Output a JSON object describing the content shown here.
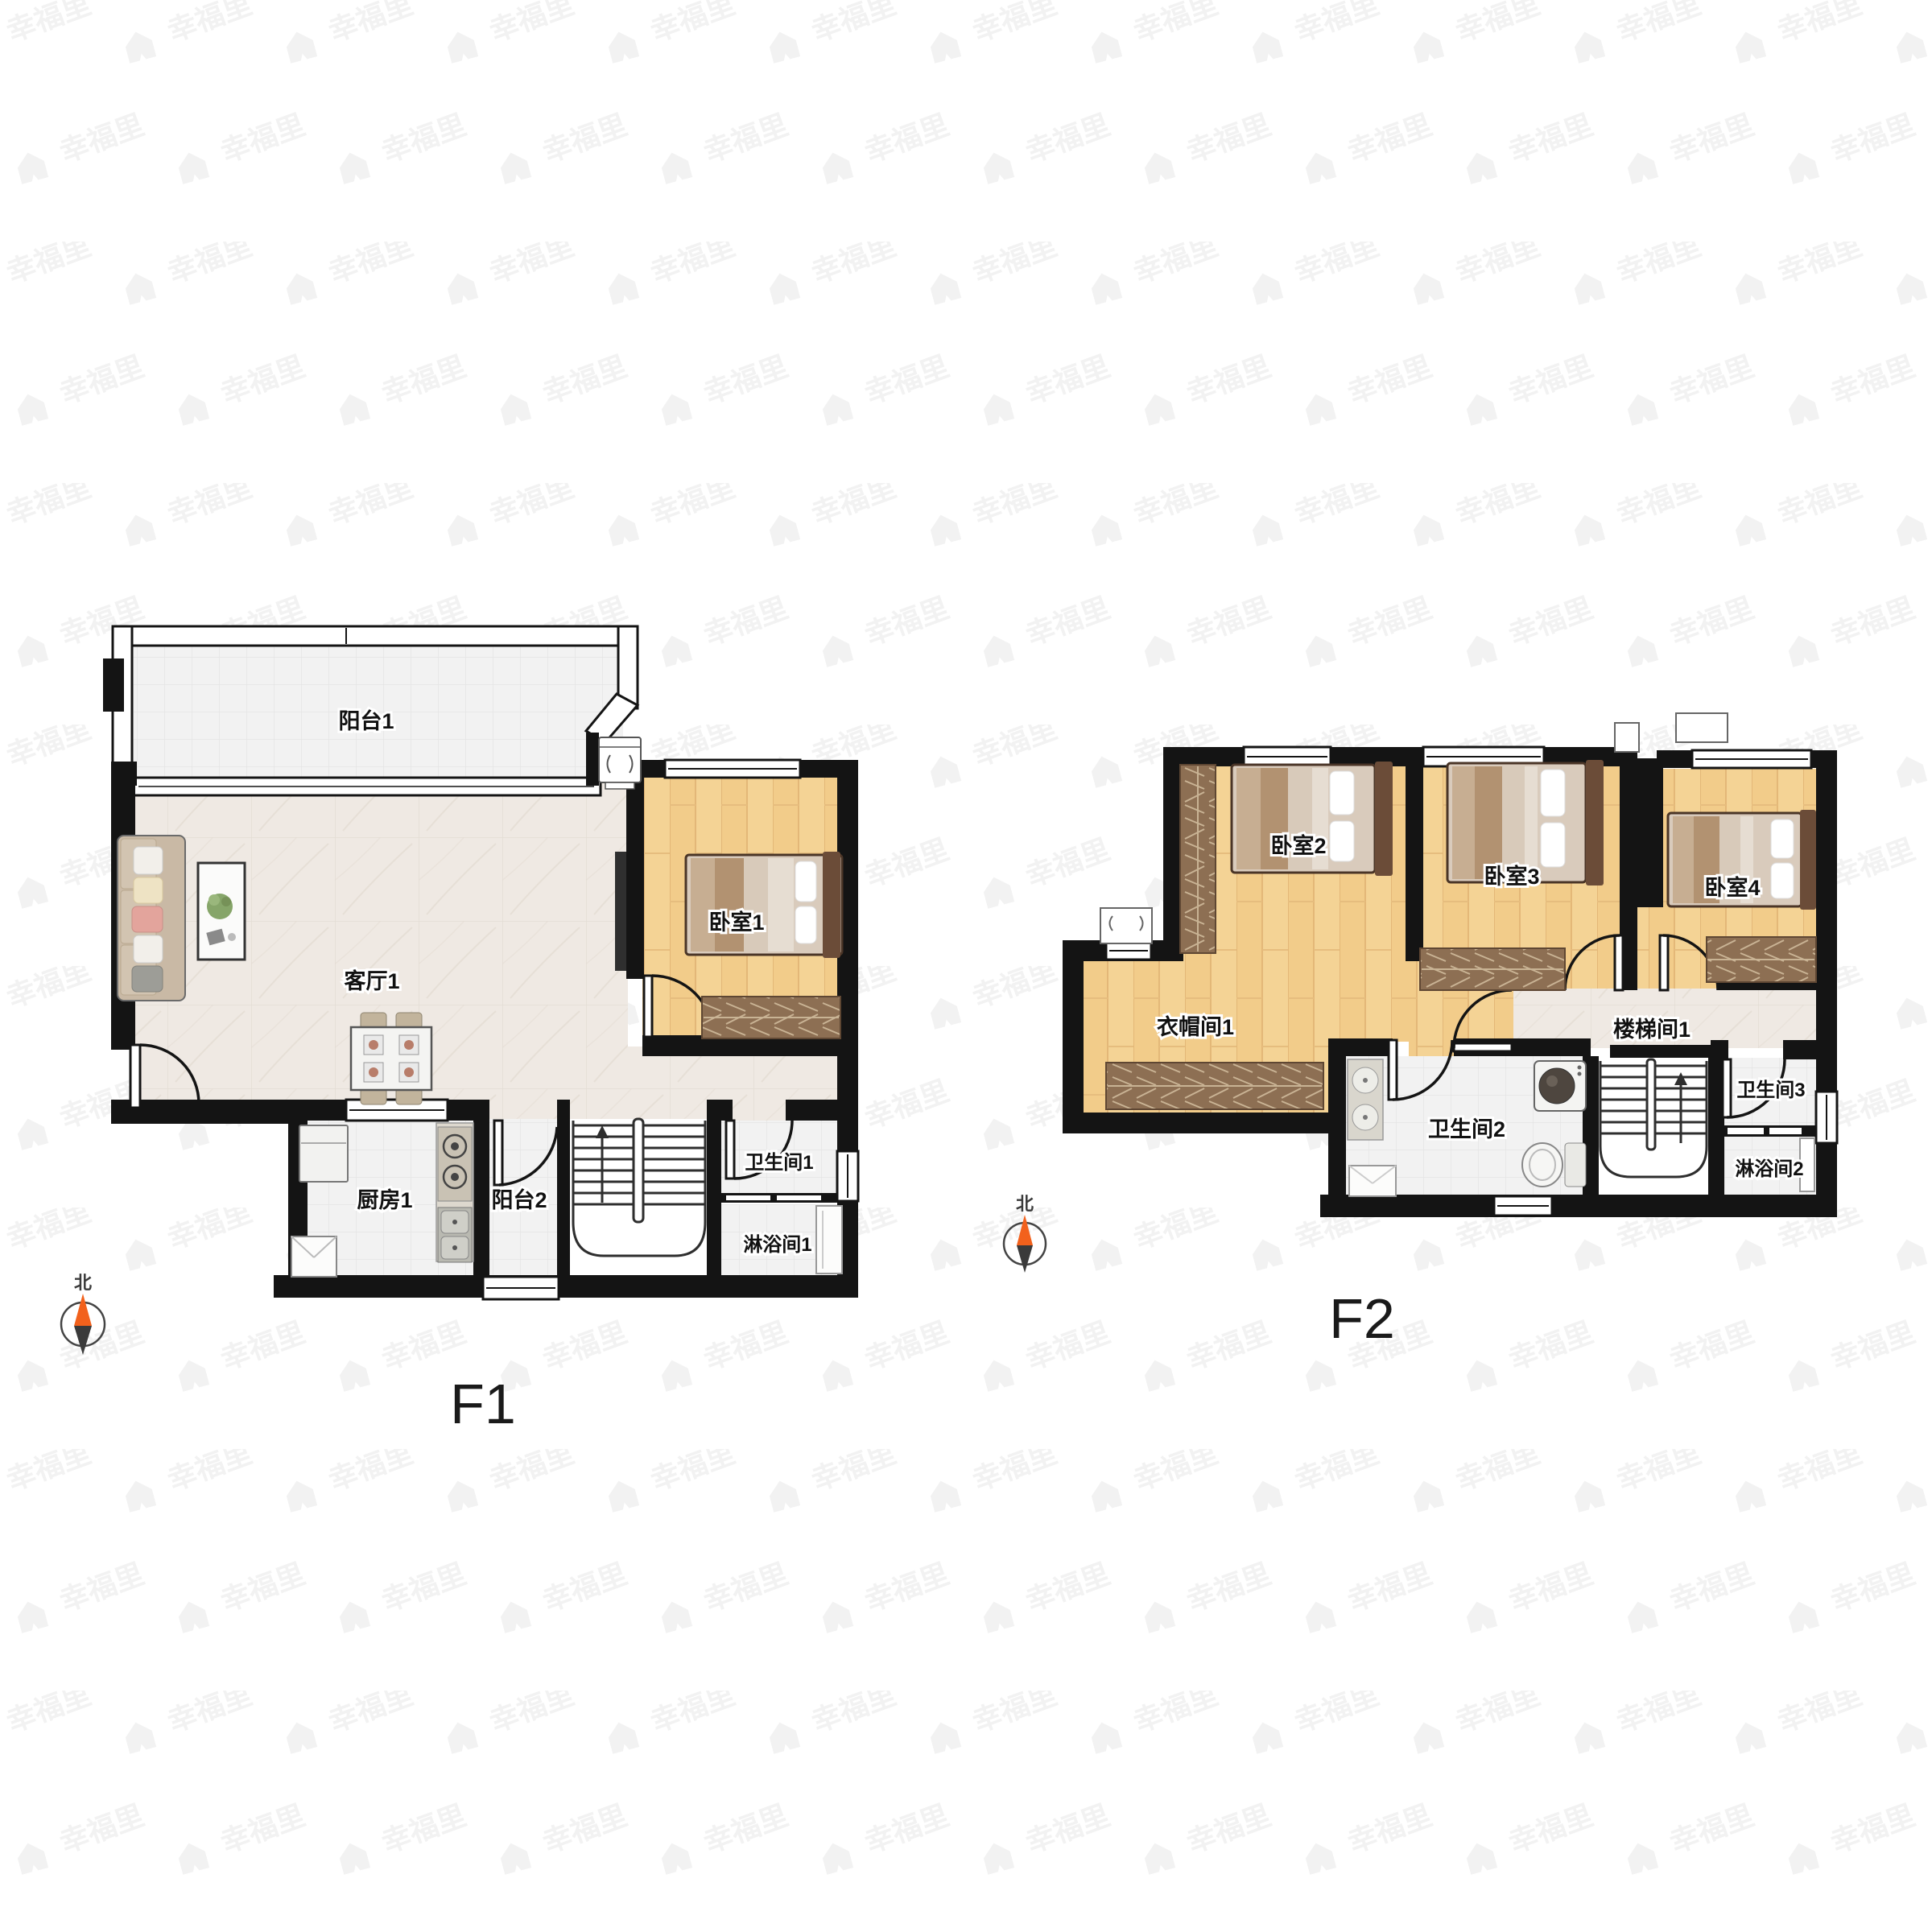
{
  "watermark": {
    "brand": "幸福里"
  },
  "compass": {
    "north": "北"
  },
  "floors": [
    {
      "title": "F1",
      "rooms": [
        {
          "id": "balcony-1",
          "label": "阳台1"
        },
        {
          "id": "living-room-1",
          "label": "客厅1"
        },
        {
          "id": "bedroom-1",
          "label": "卧室1"
        },
        {
          "id": "kitchen-1",
          "label": "厨房1"
        },
        {
          "id": "balcony-2",
          "label": "阳台2"
        },
        {
          "id": "bathroom-1",
          "label": "卫生间1"
        },
        {
          "id": "shower-1",
          "label": "淋浴间1"
        }
      ]
    },
    {
      "title": "F2",
      "rooms": [
        {
          "id": "bedroom-2",
          "label": "卧室2"
        },
        {
          "id": "bedroom-3",
          "label": "卧室3"
        },
        {
          "id": "bedroom-4",
          "label": "卧室4"
        },
        {
          "id": "cloakroom-1",
          "label": "衣帽间1"
        },
        {
          "id": "stairwell-1",
          "label": "楼梯间1"
        },
        {
          "id": "bathroom-2",
          "label": "卫生间2"
        },
        {
          "id": "bathroom-3",
          "label": "卫生间3"
        },
        {
          "id": "shower-2",
          "label": "淋浴间2"
        }
      ]
    }
  ],
  "colors": {
    "wall": "#141414",
    "wood_floor": "#f2cc8a",
    "marble_floor": "#efe9e3",
    "tile_floor": "#f2f2f2",
    "wardrobe": "#8d6f53",
    "bed_frame": "#6b4c38",
    "compass_north": "#f2611c",
    "watermark": "#f2f2f2",
    "label_text": "#111111"
  }
}
